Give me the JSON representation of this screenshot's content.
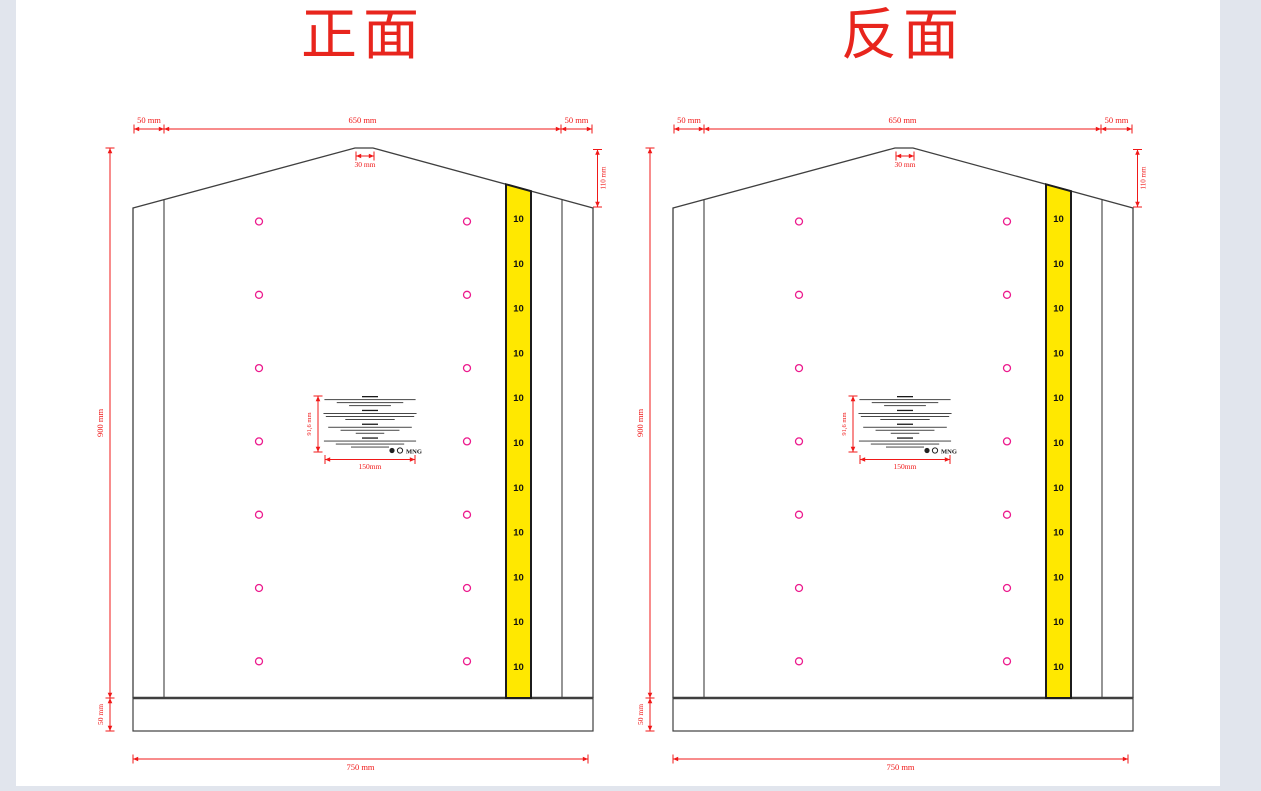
{
  "page": {
    "background": "#ffffff",
    "margin_color": "#e1e5ed",
    "outline_color": "#3f3f3f",
    "dimension_color": "#f01818",
    "title_color": "#e8251d",
    "vent_color": "#ec1a8d",
    "strip_fill": "#ffe800",
    "strip_border": "#1c1c1c",
    "microtext_color": "#1a1a1a"
  },
  "figures": [
    {
      "id": "front",
      "title": "正面"
    },
    {
      "id": "back",
      "title": "反面"
    }
  ],
  "dimensions": {
    "top_left_seam": "50 mm",
    "top_center": "650 mm",
    "top_right_seam": "50 mm",
    "peak_flat": "30 mm",
    "shoulder_fold": "110 mm",
    "body_height": "900 mm",
    "bottom_seam": "50 mm",
    "total_width": "750 mm",
    "label_height": "91,6 mm",
    "label_width": "150mm"
  },
  "tally_strip": {
    "marker": "10",
    "count": 11
  },
  "vent_holes": {
    "columns": 2,
    "rows": 7
  },
  "warning_label": {
    "brand": "MNG",
    "icons": [
      "recycle-icon",
      "green-dot-icon"
    ],
    "sections": [
      {
        "line_widths": [
          0.96,
          0.7,
          0.44
        ]
      },
      {
        "line_widths": [
          0.98,
          0.93,
          0.52
        ]
      },
      {
        "line_widths": [
          0.88,
          0.62,
          0.3
        ]
      },
      {
        "line_widths": [
          0.97,
          0.72,
          0.4
        ]
      }
    ]
  }
}
